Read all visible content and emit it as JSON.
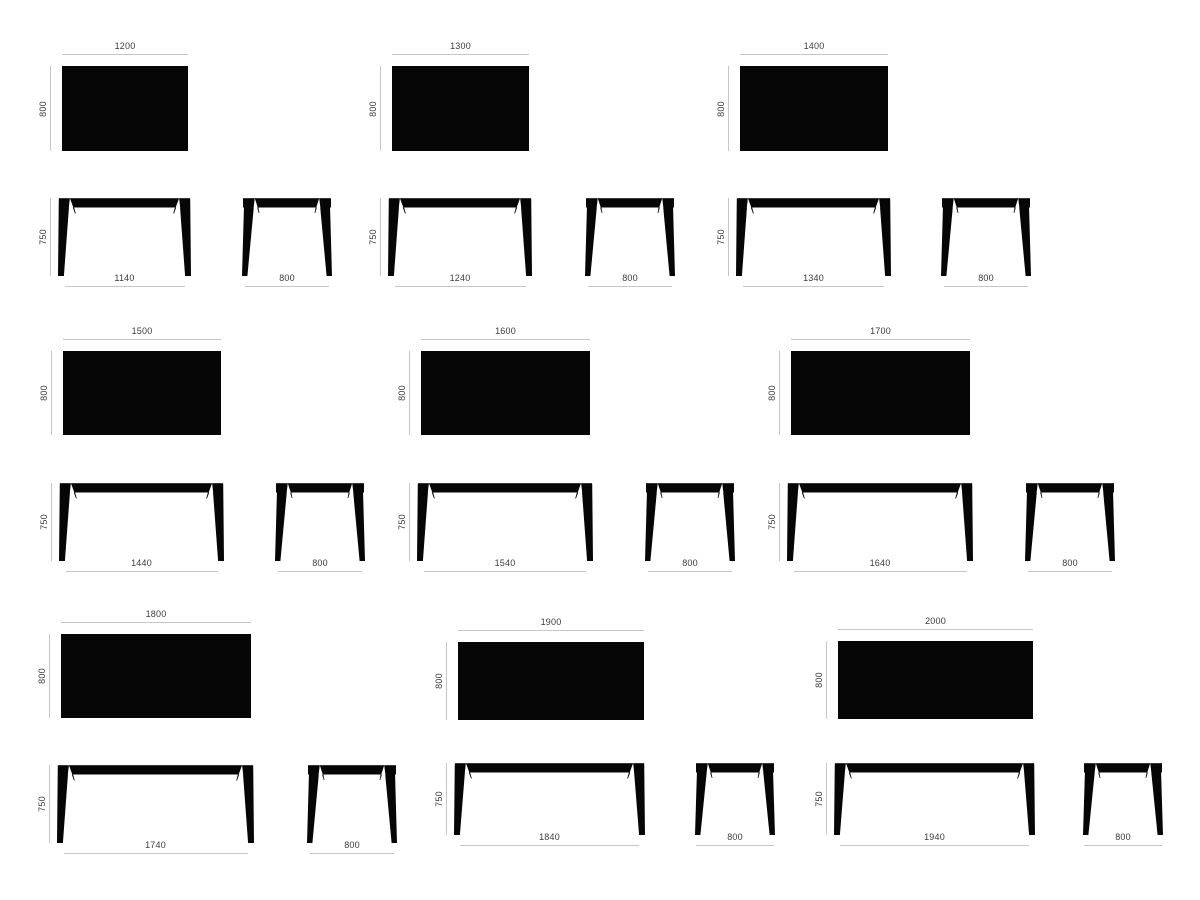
{
  "page": {
    "title": "Table dimension sheet",
    "colors": {
      "background": "#ffffff",
      "table_fill": "#060606",
      "dim_line": "#c6c6c6",
      "label": "#3b3b3b"
    }
  },
  "drawing": {
    "views_per_table": [
      "top-view",
      "front-view",
      "side-view"
    ],
    "cells": [
      {
        "name": "table-1200",
        "top_width": "1200",
        "depth": "800",
        "height": "750",
        "feet_span": "1140",
        "side_feet_span": "800"
      },
      {
        "name": "table-1300",
        "top_width": "1300",
        "depth": "800",
        "height": "750",
        "feet_span": "1240",
        "side_feet_span": "800"
      },
      {
        "name": "table-1400",
        "top_width": "1400",
        "depth": "800",
        "height": "750",
        "feet_span": "1340",
        "side_feet_span": "800"
      },
      {
        "name": "table-1500",
        "top_width": "1500",
        "depth": "800",
        "height": "750",
        "feet_span": "1440",
        "side_feet_span": "800"
      },
      {
        "name": "table-1600",
        "top_width": "1600",
        "depth": "800",
        "height": "750",
        "feet_span": "1540",
        "side_feet_span": "800"
      },
      {
        "name": "table-1700",
        "top_width": "1700",
        "depth": "800",
        "height": "750",
        "feet_span": "1640",
        "side_feet_span": "800"
      },
      {
        "name": "table-1800",
        "top_width": "1800",
        "depth": "800",
        "height": "750",
        "feet_span": "1740",
        "side_feet_span": "800"
      },
      {
        "name": "table-1900",
        "top_width": "1900",
        "depth": "800",
        "height": "750",
        "feet_span": "1840",
        "side_feet_span": "800"
      },
      {
        "name": "table-2000",
        "top_width": "2000",
        "depth": "800",
        "height": "750",
        "feet_span": "1940",
        "side_feet_span": "800"
      }
    ]
  }
}
